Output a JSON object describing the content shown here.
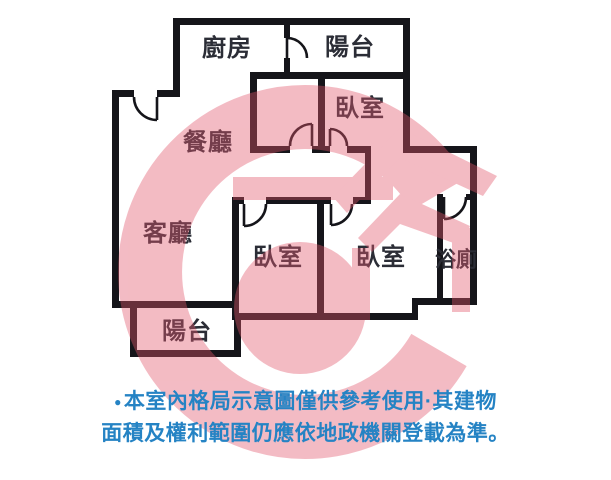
{
  "floor_plan": {
    "wall_color": "#15151a",
    "watermark_color": "#e2566b",
    "rooms": [
      {
        "id": "kitchen",
        "label": "廚房"
      },
      {
        "id": "balcony-top",
        "label": "陽台"
      },
      {
        "id": "bedroom-top",
        "label": "臥室"
      },
      {
        "id": "dining",
        "label": "餐廳"
      },
      {
        "id": "living",
        "label": "客廳"
      },
      {
        "id": "bedroom-center",
        "label": "臥室"
      },
      {
        "id": "bedroom-right",
        "label": "臥室"
      },
      {
        "id": "bathroom",
        "label": "浴廁"
      },
      {
        "id": "balcony-bottom",
        "label": "陽台"
      }
    ]
  },
  "disclaimer": {
    "bullet": "●",
    "line1": "本室內格局示意圖僅供參考使用·其建物",
    "line2": "面積及權利範圍仍應依地政機關登載為準。",
    "color": "#2583c4"
  }
}
